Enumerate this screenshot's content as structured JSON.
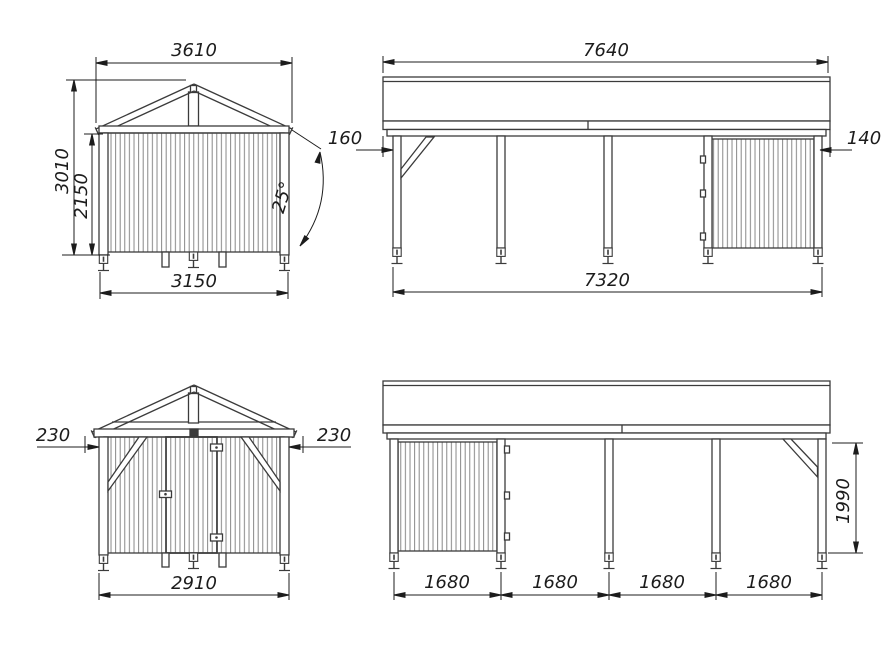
{
  "drawing": {
    "front_view_a": {
      "dims": {
        "roof_width": "3610",
        "total_height": "3010",
        "wall_height": "2150",
        "base_width": "3150",
        "roof_angle": "25°"
      }
    },
    "side_view_a": {
      "dims": {
        "roof_length": "7640",
        "left_offset": "160",
        "right_offset": "140",
        "base_length": "7320"
      }
    },
    "front_view_b": {
      "dims": {
        "left_overhang": "230",
        "right_overhang": "230",
        "base_width": "2910"
      }
    },
    "side_view_b": {
      "dims": {
        "bays": [
          "1680",
          "1680",
          "1680",
          "1680"
        ],
        "post_height": "1990"
      }
    },
    "colors": {
      "line": "#3b3b3b",
      "dimension": "#1c1c1c",
      "plank": "#7a7a7a",
      "background": "#ffffff"
    }
  }
}
